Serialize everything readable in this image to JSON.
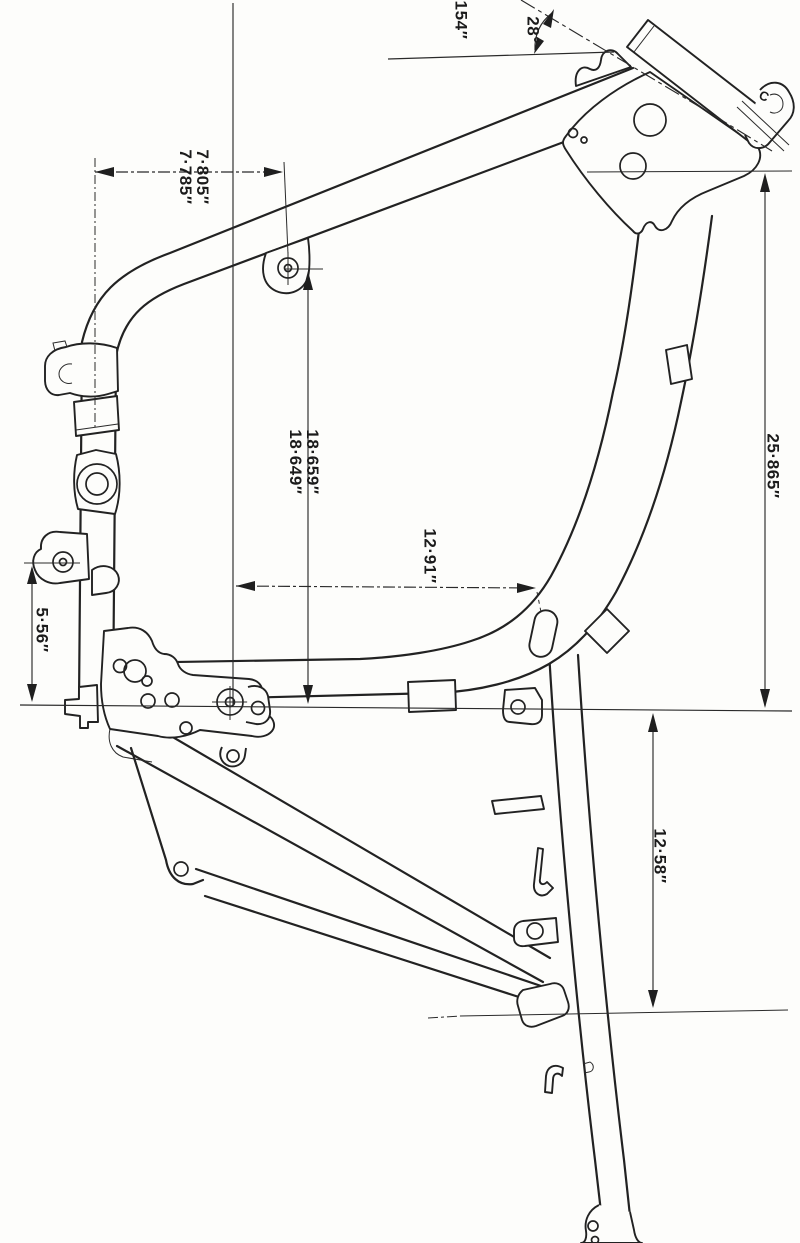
{
  "drawing": {
    "type": "motorcycle-frame-dimension-diagram",
    "ink_color": "#222222",
    "paper_color": "#fdfdfb",
    "labels": {
      "steering_axis_length": "154″",
      "steering_head_angle": "28°",
      "head_mark": "C",
      "front_offset_upper": "7·805″",
      "front_offset_lower": "7·785″",
      "mid_height_upper": "18·659″",
      "mid_height_lower": "18·649″",
      "bend_offset": "12·91″",
      "rear_height": "25·865″",
      "front_lug_height": "5·56″",
      "subframe_drop": "12·58″"
    }
  }
}
